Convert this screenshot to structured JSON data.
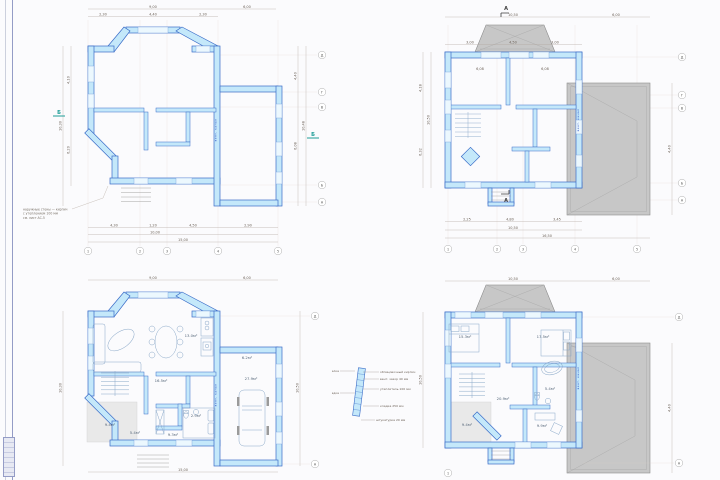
{
  "colors": {
    "wall_fill": "#c4e8fa",
    "wall_stroke": "#3a6cc8",
    "window_fill": "#ecf8fe",
    "roof_fill": "#c7c7c7",
    "roof_stroke": "#8c8c8c",
    "terrace_fill": "#e9e9e9",
    "dim_line": "#b3a89d",
    "dim_text": "#6d6258",
    "section_mark": "#1f9e98",
    "shaft_text": "#2b4fc4",
    "furniture_stroke": "#8aa8c8"
  },
  "tl": {
    "dim_top": [
      "9,00",
      "6,00"
    ],
    "dim_top_sub": [
      "2,30",
      "4,40",
      "2,30"
    ],
    "dim_bottom_sub": [
      "4,30",
      "1,20",
      "4,50",
      "2,90"
    ],
    "dim_bottom_total": "10,00",
    "dim_bottom_overall": "15,00",
    "dim_left": [
      "4,10",
      "6,20"
    ],
    "dim_left_total": "10,30",
    "dim_right": [
      "4,40",
      "6,08"
    ],
    "dim_right_total": "10,48",
    "axis_cols": [
      "1",
      "2",
      "3",
      "4",
      "5"
    ],
    "axis_rows": [
      "Д",
      "Г",
      "В",
      "Б",
      "А"
    ],
    "section_label": "Б",
    "shaft_label": "вент. канал",
    "note": [
      "наружные стены — кирпич",
      "с утеплением 100 мм",
      "см. лист АС-5"
    ]
  },
  "tr": {
    "dim_top_overall": [
      "10,50",
      "6,00"
    ],
    "dim_top_sub": [
      "3,00",
      "4,50",
      "3,00"
    ],
    "inner_dims": [
      "6,08",
      "6,08"
    ],
    "dim_bottom_sub": [
      "2,25",
      "4,80",
      "3,45"
    ],
    "dim_bottom_total": "10,50",
    "dim_bottom_overall": "16,50",
    "dim_left": [
      "4,18",
      "6,32"
    ],
    "dim_left_total": "10,50",
    "dim_right_garage": "4,40",
    "axis_cols": [
      "1",
      "2",
      "3",
      "4",
      "5"
    ],
    "axis_rows": [
      "Д",
      "Г",
      "В",
      "Б",
      "А"
    ],
    "section_label": "А",
    "shaft_label": "вент. канал"
  },
  "bl": {
    "dim_top": [
      "9,00",
      "6,00"
    ],
    "dim_left_total": "10,30",
    "dim_right_total": "10,50",
    "dim_bottom_overall": "15,00",
    "axis_top": "Д",
    "axis_bottom": "А",
    "rooms": [
      "13.0м²",
      "16.5м²",
      "2.9м²",
      "9.3м²",
      "5.4м²",
      "9.4м²",
      "6.2м²",
      "27.9м²"
    ],
    "shaft_label": "вент. канал"
  },
  "br": {
    "dim_top": [
      "10,50",
      "6,00"
    ],
    "dim_left_total": "10,50",
    "dim_right_garage": "4,40",
    "axis_top": "Д",
    "axis_bottom": "А",
    "axis_col1": "1",
    "rooms": [
      "15.3м²",
      "17.5м²",
      "20.9м²",
      "5.4м²",
      "9.9м²",
      "9.4м²"
    ],
    "shaft_label": "вент. канал"
  },
  "legend": {
    "right": [
      "облицовочный кирпич",
      "вент. зазор 40 мм",
      "утеплитель 100 мм",
      "кладка 250 мм"
    ],
    "bottom": "штукатурка 20 мм",
    "left": [
      "отделка",
      "кладка"
    ]
  }
}
